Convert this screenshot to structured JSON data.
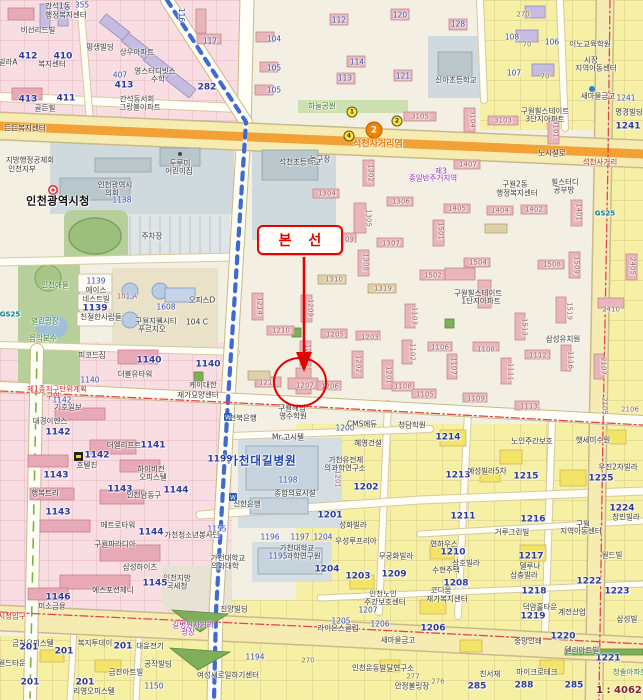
{
  "annotation": {
    "label": "본 선",
    "color": "#e60000"
  },
  "station": {
    "line": "2",
    "name": "석천사거리역",
    "line_color": "#f08300",
    "exits": [
      {
        "no": "1",
        "x": 352,
        "y": 112
      },
      {
        "no": "2",
        "x": 397,
        "y": 121
      },
      {
        "no": "4",
        "x": 349,
        "y": 136
      }
    ]
  },
  "scale_text": "1 : 4062",
  "colors": {
    "annotation_red": "#e60000",
    "road_orange": "#f2a137",
    "subway_blue": "#3f6bd0",
    "parcel_yellow": "#f6f0a4",
    "commercial_pink": "#f8dde2",
    "public_gray_blue": "#cfd9de",
    "park_green": "#b7cf9a"
  },
  "labels": [
    [
      "355",
      82,
      5,
      "n"
    ],
    [
      "간석1동",
      58,
      6,
      "d"
    ],
    [
      "행정복지센터",
      66,
      15,
      "d"
    ],
    [
      "비선리드빌",
      38,
      30,
      "d"
    ],
    [
      "412",
      28,
      57,
      "b"
    ],
    [
      "410",
      63,
      57,
      "b"
    ],
    [
      "복지센터",
      52,
      64,
      "d"
    ],
    [
      "빌라A",
      8,
      62,
      "d"
    ],
    [
      "413",
      28,
      100,
      "b"
    ],
    [
      "411",
      66,
      99,
      "b"
    ],
    [
      "골든힐",
      45,
      108,
      "d"
    ],
    [
      "평생빌딩",
      100,
      47,
      "d"
    ],
    [
      "상우아파트",
      137,
      52,
      "d"
    ],
    [
      "영스터디빗스",
      155,
      71,
      "d"
    ],
    [
      "수학",
      158,
      79,
      "d"
    ],
    [
      "407",
      120,
      75,
      "n"
    ],
    [
      "413",
      124,
      86,
      "b"
    ],
    [
      "간석동서희",
      137,
      99,
      "d"
    ],
    [
      "그랑블아파트",
      140,
      107,
      "d"
    ],
    [
      "282",
      207,
      88,
      "b"
    ],
    [
      "116",
      181,
      15,
      "n9"
    ],
    [
      "117",
      210,
      41,
      "n"
    ],
    [
      "든든복지센터",
      25,
      128,
      "d"
    ],
    [
      "112",
      339,
      20,
      "n"
    ],
    [
      "120",
      400,
      15,
      "n"
    ],
    [
      "128",
      458,
      24,
      "n"
    ],
    [
      "114",
      357,
      62,
      "n"
    ],
    [
      "113",
      345,
      78,
      "n"
    ],
    [
      "121",
      403,
      76,
      "n"
    ],
    [
      "신아초등학교",
      456,
      80,
      "d"
    ],
    [
      "270",
      523,
      15,
      "o"
    ],
    [
      "70",
      527,
      45,
      "o"
    ],
    [
      "70",
      545,
      77,
      "o"
    ],
    [
      "108",
      512,
      37,
      "n"
    ],
    [
      "107",
      514,
      73,
      "n"
    ],
    [
      "106",
      552,
      42,
      "n"
    ],
    [
      "104",
      274,
      39,
      "n"
    ],
    [
      "105",
      274,
      68,
      "n"
    ],
    [
      "105",
      274,
      90,
      "n"
    ],
    [
      "이노교육학원",
      590,
      44,
      "d"
    ],
    [
      "시장",
      591,
      60,
      "d"
    ],
    [
      "지역아동센터",
      596,
      68,
      "d"
    ],
    [
      "새마을금고",
      598,
      96,
      "d"
    ],
    [
      "1241",
      626,
      98,
      "n"
    ],
    [
      "명경빌딩",
      629,
      112,
      "d"
    ],
    [
      "1241",
      628,
      127,
      "b"
    ],
    [
      "구월힐스테이트",
      545,
      111,
      "d"
    ],
    [
      "3단지아파트",
      545,
      119,
      "d"
    ],
    [
      "3105",
      420,
      117,
      "a"
    ],
    [
      "3104",
      472,
      119,
      "a9"
    ],
    [
      "3103",
      503,
      121,
      "a"
    ],
    [
      "3101",
      555,
      129,
      "a9"
    ],
    [
      "하늘공원",
      322,
      106,
      "g"
    ],
    [
      "노시설로",
      552,
      153,
      "d"
    ],
    [
      "석천사거리",
      600,
      162,
      "r"
    ],
    [
      "석천초등학교",
      300,
      162,
      "d"
    ],
    [
      "지방행정공제회",
      30,
      160,
      "d"
    ],
    [
      "인천지부",
      22,
      169,
      "d"
    ],
    [
      "인천광역시청",
      58,
      201,
      "db"
    ],
    [
      "인천광역시",
      115,
      185,
      "d"
    ],
    [
      "의회",
      112,
      193,
      "d"
    ],
    [
      "1138",
      122,
      200,
      "n"
    ],
    [
      "두루미",
      180,
      163,
      "d"
    ],
    [
      "어린이집",
      179,
      171,
      "d"
    ],
    [
      "주차장",
      152,
      236,
      "d"
    ],
    [
      "인천애뜰",
      55,
      285,
      "g"
    ],
    [
      "열린광장",
      45,
      321,
      "g"
    ],
    [
      "음악분수",
      43,
      338,
      "g"
    ],
    [
      "GS25",
      10,
      315,
      "gs"
    ],
    [
      "1139",
      96,
      281,
      "n"
    ],
    [
      "에이스",
      96,
      290,
      "d"
    ],
    [
      "네스트빌",
      96,
      299,
      "d"
    ],
    [
      "1139",
      95,
      309,
      "b"
    ],
    [
      "친절한사람들",
      101,
      317,
      "d"
    ],
    [
      "101 A",
      127,
      297,
      "a"
    ],
    [
      "1608",
      166,
      307,
      "n"
    ],
    [
      "구월지웰시티",
      156,
      321,
      "d"
    ],
    [
      "푸르지오",
      152,
      329,
      "d"
    ],
    [
      "오피스D",
      202,
      300,
      "d"
    ],
    [
      "104 C",
      197,
      322,
      "d"
    ],
    [
      "1305",
      368,
      218,
      "a9"
    ],
    [
      "1309",
      345,
      240,
      "a"
    ],
    [
      "1307",
      391,
      244,
      "a"
    ],
    [
      "1308",
      365,
      262,
      "a9"
    ],
    [
      "1310",
      334,
      280,
      "a"
    ],
    [
      "1319",
      383,
      289,
      "a"
    ],
    [
      "1209",
      310,
      308,
      "a9"
    ],
    [
      "1214",
      259,
      306,
      "a9"
    ],
    [
      "1210",
      281,
      331,
      "a"
    ],
    [
      "1205",
      335,
      335,
      "a"
    ],
    [
      "1203",
      370,
      338,
      "a"
    ],
    [
      "1208",
      307,
      353,
      "a9"
    ],
    [
      "1211",
      268,
      383,
      "a"
    ],
    [
      "1207",
      305,
      386,
      "a"
    ],
    [
      "1206",
      330,
      387,
      "a"
    ],
    [
      "1202",
      358,
      364,
      "a9"
    ],
    [
      "1201",
      388,
      375,
      "a9"
    ],
    [
      "1103",
      414,
      316,
      "a9"
    ],
    [
      "1102",
      412,
      352,
      "a9"
    ],
    [
      "1108",
      403,
      387,
      "a"
    ],
    [
      "1502",
      433,
      276,
      "a"
    ],
    [
      "1513",
      524,
      327,
      "a9"
    ],
    [
      "1519",
      569,
      311,
      "a9"
    ],
    [
      "1106",
      440,
      348,
      "a"
    ],
    [
      "1108",
      486,
      350,
      "a"
    ],
    [
      "1107",
      453,
      366,
      "a9"
    ],
    [
      "1112",
      538,
      356,
      "a"
    ],
    [
      "1116",
      570,
      360,
      "a9"
    ],
    [
      "1111",
      510,
      372,
      "a9"
    ],
    [
      "1105",
      425,
      395,
      "a"
    ],
    [
      "1109",
      476,
      399,
      "a"
    ],
    [
      "1113",
      529,
      407,
      "a"
    ],
    [
      "2107",
      603,
      366,
      "a9"
    ],
    [
      "2410",
      611,
      310,
      "a"
    ],
    [
      "구월힐스테이트",
      478,
      293,
      "d"
    ],
    [
      "1단지아파트",
      481,
      301,
      "d"
    ],
    [
      "삼성유치원",
      563,
      339,
      "d"
    ],
    [
      "제3",
      441,
      171,
      "p"
    ],
    [
      "종일반주거지역",
      433,
      178,
      "p"
    ],
    [
      "1302",
      370,
      173,
      "a9"
    ],
    [
      "1304",
      327,
      194,
      "a"
    ],
    [
      "1306",
      401,
      202,
      "a"
    ],
    [
      "1407",
      468,
      165,
      "a"
    ],
    [
      "1405",
      457,
      209,
      "a"
    ],
    [
      "1404",
      500,
      211,
      "a"
    ],
    [
      "1402",
      534,
      210,
      "a"
    ],
    [
      "1401",
      578,
      212,
      "a9"
    ],
    [
      "1501",
      440,
      231,
      "a9"
    ],
    [
      "1504",
      478,
      263,
      "a"
    ],
    [
      "1508",
      552,
      265,
      "a"
    ],
    [
      "1509",
      576,
      265,
      "a9"
    ],
    [
      "2405",
      632,
      266,
      "a9"
    ],
    [
      "농구장",
      320,
      159,
      "d"
    ],
    [
      "구월2동",
      515,
      184,
      "d"
    ],
    [
      "행정복지센터",
      517,
      193,
      "d"
    ],
    [
      "힐스터디",
      565,
      182,
      "d"
    ],
    [
      "공부방",
      564,
      190,
      "d"
    ],
    [
      "GS25",
      605,
      214,
      "gs"
    ],
    [
      "1140",
      149,
      361,
      "b"
    ],
    [
      "1140",
      208,
      365,
      "b"
    ],
    [
      "1140",
      90,
      380,
      "n"
    ],
    [
      "더블유타워",
      135,
      374,
      "d"
    ],
    [
      "피코드짐",
      92,
      355,
      "d"
    ],
    [
      "케이대한",
      203,
      385,
      "d"
    ],
    [
      "재가요양센터",
      198,
      395,
      "d"
    ],
    [
      "제1종지구단위계획",
      57,
      389,
      "r"
    ],
    [
      "구역",
      53,
      396,
      "r"
    ],
    [
      "1142",
      62,
      400,
      "n"
    ],
    [
      "기호일보",
      68,
      407,
      "d"
    ],
    [
      "대경이엔스",
      50,
      421,
      "d"
    ],
    [
      "1142",
      58,
      433,
      "b"
    ],
    [
      "더엘리프트",
      124,
      445,
      "d"
    ],
    [
      "1141",
      153,
      446,
      "b"
    ],
    [
      "1142",
      97,
      456,
      "b"
    ],
    [
      "호텔진",
      87,
      465,
      "d"
    ],
    [
      "하이비전",
      151,
      469,
      "d"
    ],
    [
      "오피스텔",
      153,
      477,
      "d"
    ],
    [
      "1143",
      56,
      476,
      "b"
    ],
    [
      "행복트리",
      45,
      493,
      "d"
    ],
    [
      "1143",
      120,
      490,
      "b"
    ],
    [
      "인천남동구",
      144,
      495,
      "d"
    ],
    [
      "1144",
      176,
      491,
      "b"
    ],
    [
      "1143",
      58,
      513,
      "b"
    ],
    [
      "메트로타워",
      118,
      525,
      "d"
    ],
    [
      "1155",
      217,
      529,
      "n"
    ],
    [
      "1144",
      151,
      533,
      "b"
    ],
    [
      "가천청소년봉사단",
      192,
      535,
      "d"
    ],
    [
      "구월파라디아",
      115,
      544,
      "d"
    ],
    [
      "삼성하이츠",
      140,
      567,
      "d"
    ],
    [
      "인천지방",
      177,
      578,
      "d"
    ],
    [
      "국세청",
      177,
      586,
      "d"
    ],
    [
      "1145",
      155,
      584,
      "b"
    ],
    [
      "1146",
      58,
      598,
      "b"
    ],
    [
      "에스포션제니",
      113,
      590,
      "d"
    ],
    [
      "미소금융",
      52,
      606,
      "d"
    ],
    [
      "시청입구",
      12,
      616,
      "r"
    ],
    [
      "진양빌딩",
      234,
      609,
      "d"
    ],
    [
      "길병원사거리",
      193,
      625,
      "p"
    ],
    [
      "광장",
      188,
      632,
      "p"
    ],
    [
      "금하오피스텔",
      33,
      643,
      "d"
    ],
    [
      "복지투데이",
      95,
      643,
      "d"
    ],
    [
      "대윤전기",
      150,
      646,
      "d"
    ],
    [
      "201",
      29,
      648,
      "b"
    ],
    [
      "201",
      64,
      652,
      "b"
    ],
    [
      "201",
      123,
      647,
      "b"
    ],
    [
      "201",
      30,
      683,
      "b"
    ],
    [
      "201",
      85,
      683,
      "b"
    ],
    [
      "공작빌딩",
      158,
      664,
      "d"
    ],
    [
      "금잔아트빌",
      126,
      672,
      "d"
    ],
    [
      "리영오피스텔",
      94,
      691,
      "d"
    ],
    [
      "1150",
      154,
      686,
      "n"
    ],
    [
      "월드타운",
      12,
      663,
      "d"
    ],
    [
      "여성새로일하기센터",
      228,
      675,
      "d"
    ],
    [
      "1194",
      255,
      657,
      "n"
    ],
    [
      "270",
      308,
      661,
      "o"
    ],
    [
      "가천대학교",
      228,
      558,
      "d"
    ],
    [
      "의과대학",
      225,
      566,
      "d"
    ],
    [
      "전북은행",
      243,
      418,
      "d"
    ],
    [
      "구월해법",
      292,
      408,
      "d"
    ],
    [
      "영수학원",
      293,
      416,
      "d"
    ],
    [
      "Mr.고시텔",
      288,
      437,
      "d"
    ],
    [
      "1200",
      345,
      428,
      "n"
    ],
    [
      "혜영건설",
      368,
      443,
      "d"
    ],
    [
      "CMS에듀",
      362,
      424,
      "d"
    ],
    [
      "청담학원",
      412,
      425,
      "d"
    ],
    [
      "가천대길병원",
      262,
      461,
      "blb"
    ],
    [
      "1198",
      288,
      480,
      "n"
    ],
    [
      "종합의료시설",
      295,
      493,
      "d"
    ],
    [
      "가천유전체",
      346,
      460,
      "d"
    ],
    [
      "의과학연구소",
      345,
      468,
      "d"
    ],
    [
      "1201",
      337,
      479,
      "a9"
    ],
    [
      "1202",
      366,
      488,
      "b"
    ],
    [
      "1201",
      330,
      516,
      "b"
    ],
    [
      "신한은행",
      247,
      504,
      "d"
    ],
    [
      "1199",
      220,
      460,
      "b"
    ],
    [
      "성화빌라",
      353,
      525,
      "d"
    ],
    [
      "1196",
      270,
      537,
      "n"
    ],
    [
      "1197",
      300,
      537,
      "n"
    ],
    [
      "1204",
      323,
      537,
      "n"
    ],
    [
      "우성루프리아",
      356,
      541,
      "d"
    ],
    [
      "가천대학교",
      297,
      548,
      "d"
    ],
    [
      "뇌과학연구원",
      300,
      556,
      "d"
    ],
    [
      "무궁화빌라",
      396,
      556,
      "d"
    ],
    [
      "1195",
      278,
      556,
      "n"
    ],
    [
      "1214",
      448,
      438,
      "b"
    ],
    [
      "1213",
      458,
      476,
      "b"
    ],
    [
      "1215",
      526,
      477,
      "b"
    ],
    [
      "1225",
      601,
      479,
      "b"
    ],
    [
      "1224",
      622,
      509,
      "b"
    ],
    [
      "1211",
      463,
      517,
      "b"
    ],
    [
      "1216",
      533,
      520,
      "b"
    ],
    [
      "1210",
      453,
      553,
      "b"
    ],
    [
      "1217",
      531,
      557,
      "b"
    ],
    [
      "노인주간보호",
      532,
      441,
      "d"
    ],
    [
      "햇세미수원",
      593,
      440,
      "d"
    ],
    [
      "예성빌라5차",
      487,
      471,
      "d"
    ],
    [
      "우진2차빌라",
      618,
      467,
      "d"
    ],
    [
      "구월",
      583,
      524,
      "d"
    ],
    [
      "지역아동센터",
      581,
      531,
      "d"
    ],
    [
      "거루그린빌",
      512,
      532,
      "d"
    ],
    [
      "연하우스",
      444,
      544,
      "d"
    ],
    [
      "삼호빌라",
      466,
      563,
      "d"
    ],
    [
      "창민빌라",
      626,
      517,
      "d"
    ],
    [
      "월드빌",
      612,
      555,
      "d"
    ],
    [
      "델루나",
      530,
      566,
      "d"
    ],
    [
      "2105",
      604,
      406,
      "a9"
    ],
    [
      "2106",
      630,
      410,
      "a"
    ],
    [
      "1204",
      327,
      570,
      "b"
    ],
    [
      "1203",
      358,
      577,
      "b"
    ],
    [
      "1209",
      394,
      575,
      "b"
    ],
    [
      "1208",
      456,
      584,
      "b"
    ],
    [
      "1218",
      534,
      592,
      "b"
    ],
    [
      "1222",
      589,
      582,
      "b"
    ],
    [
      "1223",
      617,
      592,
      "b"
    ],
    [
      "1219",
      533,
      617,
      "b"
    ],
    [
      "1220",
      563,
      637,
      "b"
    ],
    [
      "1221",
      608,
      659,
      "b"
    ],
    [
      "수현주택",
      446,
      570,
      "d"
    ],
    [
      "코디움",
      441,
      590,
      "d"
    ],
    [
      "인천노인",
      383,
      594,
      "d"
    ],
    [
      "주간보호센터",
      385,
      602,
      "d"
    ],
    [
      "재가복지센터",
      447,
      599,
      "d"
    ],
    [
      "삼충빌라",
      524,
      575,
      "d"
    ],
    [
      "덕암홀타운",
      540,
      607,
      "d"
    ],
    [
      "계전산업",
      572,
      612,
      "d"
    ],
    [
      "삼성빌",
      627,
      619,
      "d"
    ],
    [
      "1207",
      368,
      610,
      "n"
    ],
    [
      "1205",
      341,
      621,
      "n"
    ],
    [
      "1206",
      380,
      624,
      "n"
    ],
    [
      "1206",
      433,
      629,
      "b"
    ],
    [
      "라이온스클럽",
      338,
      628,
      "d"
    ],
    [
      "새마을금고",
      398,
      640,
      "d"
    ],
    [
      "중앙인쇄",
      528,
      641,
      "d"
    ],
    [
      "델리아트빌",
      582,
      650,
      "d"
    ],
    [
      "청솔아파트",
      630,
      672,
      "g"
    ],
    [
      "인천운동발달연구소",
      383,
      668,
      "d"
    ],
    [
      "277",
      413,
      677,
      "o"
    ],
    [
      "276",
      438,
      682,
      "o"
    ],
    [
      "안정볼링장",
      412,
      686,
      "d"
    ],
    [
      "친서재",
      490,
      674,
      "d"
    ],
    [
      "마이크로테크",
      537,
      672,
      "d"
    ],
    [
      "285",
      477,
      687,
      "b"
    ],
    [
      "288",
      524,
      686,
      "b"
    ],
    [
      "285",
      574,
      686,
      "b"
    ]
  ]
}
